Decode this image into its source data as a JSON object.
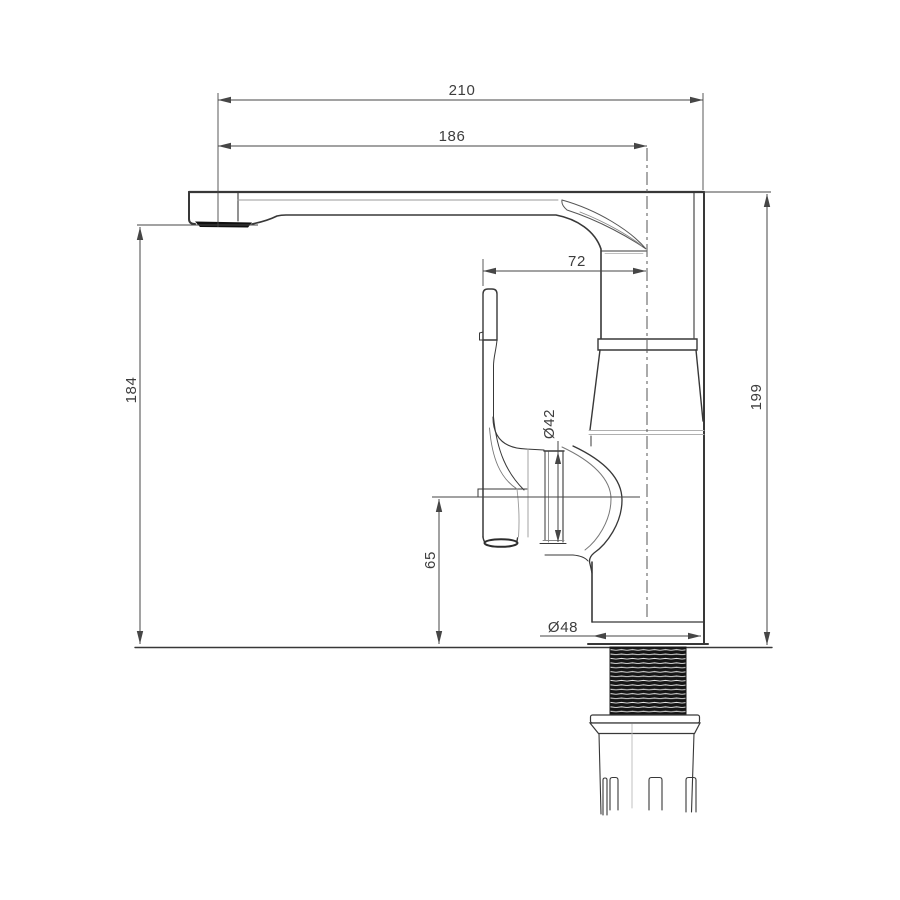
{
  "drawing": {
    "dimensions": {
      "spout_reach_overall": "210",
      "spout_reach_to_center": "186",
      "handle_to_center": "72",
      "spout_height": "184",
      "overall_height": "199",
      "base_to_pivot_height": "65",
      "body_diameter": "Ø42",
      "base_diameter": "Ø48"
    },
    "colors": {
      "background": "#ffffff",
      "outline": "#383838",
      "dimension_lines": "#464646",
      "thread_fill": "#161616",
      "light_detail": "#9a9a9a"
    }
  }
}
